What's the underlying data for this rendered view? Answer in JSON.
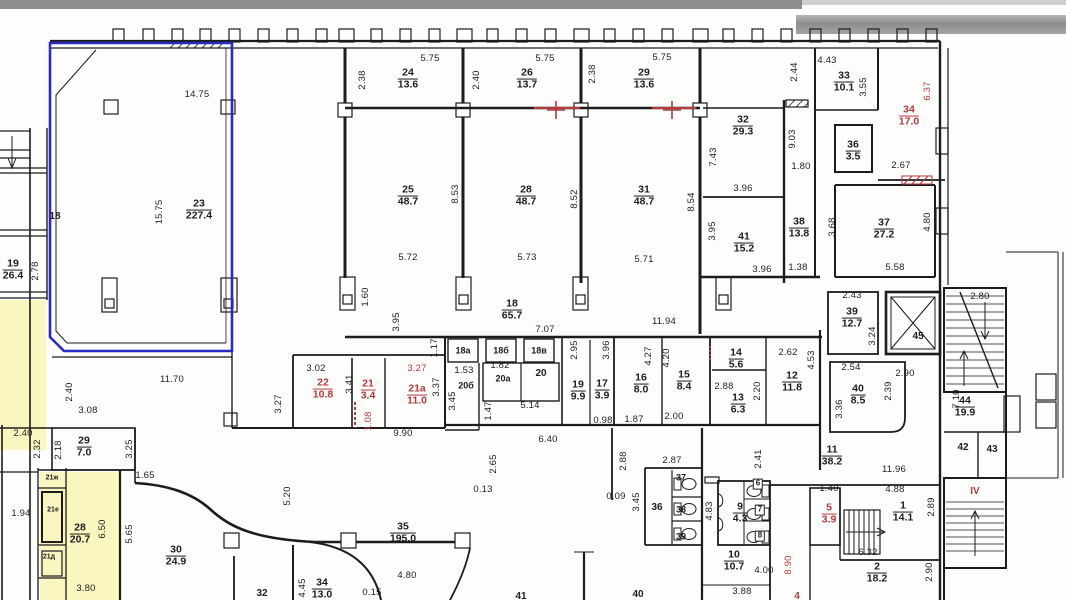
{
  "plan": {
    "type": "architectural floor plan (scanned)",
    "colors": {
      "wall": "#1c1c1c",
      "highlight_outline_blue": "#2a2ac0",
      "accent_red": "#b43b3c",
      "highlight_fill_yellow": "#f8f5b5",
      "scan_edge_gray": "#8d8d8d"
    },
    "rooms": [
      {
        "n": "23",
        "a": "227.4",
        "x": 199,
        "y": 210
      },
      {
        "n": "24",
        "a": "13.6",
        "x": 408,
        "y": 79
      },
      {
        "n": "26",
        "a": "13.7",
        "x": 527,
        "y": 79
      },
      {
        "n": "29",
        "a": "13.6",
        "x": 644,
        "y": 79
      },
      {
        "n": "33",
        "a": "10.1",
        "x": 844,
        "y": 82
      },
      {
        "n": "34",
        "a": "17.0",
        "x": 909,
        "y": 116,
        "c": "red"
      },
      {
        "n": "32",
        "a": "29.3",
        "x": 743,
        "y": 126
      },
      {
        "n": "36",
        "a": "3.5",
        "x": 853,
        "y": 151
      },
      {
        "n": "25",
        "a": "48.7",
        "x": 408,
        "y": 196
      },
      {
        "n": "28",
        "a": "48.7",
        "x": 526,
        "y": 196
      },
      {
        "n": "31",
        "a": "48.7",
        "x": 644,
        "y": 196
      },
      {
        "n": "41",
        "a": "15.2",
        "x": 744,
        "y": 243
      },
      {
        "n": "38",
        "a": "13.8",
        "x": 799,
        "y": 228
      },
      {
        "n": "37",
        "a": "27.2",
        "x": 884,
        "y": 229
      },
      {
        "n": "19",
        "a": "26.4",
        "x": 13,
        "y": 270
      },
      {
        "n": "18",
        "a": "65.7",
        "x": 512,
        "y": 310
      },
      {
        "n": "39",
        "a": "12.7",
        "x": 852,
        "y": 318
      },
      {
        "n": "22",
        "a": "10.8",
        "x": 323,
        "y": 389,
        "c": "red"
      },
      {
        "n": "21",
        "a": "3.4",
        "x": 368,
        "y": 390,
        "c": "red"
      },
      {
        "n": "21а",
        "a": "11.0",
        "x": 417,
        "y": 395,
        "c": "red"
      },
      {
        "n": "19",
        "a": "9.9",
        "x": 578,
        "y": 391
      },
      {
        "n": "17",
        "a": "3.9",
        "x": 602,
        "y": 390
      },
      {
        "n": "16",
        "a": "8.0",
        "x": 641,
        "y": 384
      },
      {
        "n": "15",
        "a": "8.4",
        "x": 684,
        "y": 381
      },
      {
        "n": "14",
        "a": "5.6",
        "x": 736,
        "y": 359
      },
      {
        "n": "13",
        "a": "6.3",
        "x": 738,
        "y": 404
      },
      {
        "n": "12",
        "a": "11.8",
        "x": 792,
        "y": 382
      },
      {
        "n": "40",
        "a": "8.5",
        "x": 858,
        "y": 395
      },
      {
        "n": "44",
        "a": "19.9",
        "x": 965,
        "y": 407
      },
      {
        "n": "29",
        "a": "7.0",
        "x": 84,
        "y": 447
      },
      {
        "n": "28",
        "a": "20.7",
        "x": 80,
        "y": 534
      },
      {
        "n": "30",
        "a": "24.9",
        "x": 176,
        "y": 556
      },
      {
        "n": "11",
        "a": "38.2",
        "x": 832,
        "y": 456
      },
      {
        "n": "35",
        "a": "195.0",
        "x": 403,
        "y": 533
      },
      {
        "n": "9",
        "a": "4.3",
        "x": 740,
        "y": 513
      },
      {
        "n": "10",
        "a": "10.7",
        "x": 734,
        "y": 561
      },
      {
        "n": "5",
        "a": "3.9",
        "x": 829,
        "y": 514,
        "c": "red"
      },
      {
        "n": "1",
        "a": "14.1",
        "x": 903,
        "y": 512
      },
      {
        "n": "2",
        "a": "18.2",
        "x": 877,
        "y": 573
      },
      {
        "n": "34",
        "a": "13.0",
        "x": 322,
        "y": 589
      }
    ],
    "texts": [
      {
        "t": "18",
        "x": 55,
        "y": 217
      },
      {
        "t": "18а",
        "x": 463,
        "y": 351,
        "s": 9
      },
      {
        "t": "18б",
        "x": 501,
        "y": 351,
        "s": 9
      },
      {
        "t": "18в",
        "x": 539,
        "y": 351,
        "s": 9
      },
      {
        "t": "20б",
        "x": 466,
        "y": 386,
        "s": 9
      },
      {
        "t": "20а",
        "x": 503,
        "y": 379,
        "s": 9
      },
      {
        "t": "20",
        "x": 541,
        "y": 374
      },
      {
        "t": "45",
        "x": 918,
        "y": 337
      },
      {
        "t": "36",
        "x": 657,
        "y": 508
      },
      {
        "t": "37",
        "x": 681,
        "y": 478,
        "s": 9
      },
      {
        "t": "38",
        "x": 681,
        "y": 510,
        "s": 9
      },
      {
        "t": "39",
        "x": 681,
        "y": 537,
        "s": 9
      },
      {
        "t": "6",
        "x": 758,
        "y": 484,
        "s": 8,
        "b": 1
      },
      {
        "t": "7",
        "x": 760,
        "y": 510,
        "s": 8,
        "b": 1
      },
      {
        "t": "8",
        "x": 760,
        "y": 536,
        "s": 8,
        "b": 1
      },
      {
        "t": "42",
        "x": 963,
        "y": 448
      },
      {
        "t": "43",
        "x": 992,
        "y": 450
      },
      {
        "t": "32",
        "x": 262,
        "y": 594
      },
      {
        "t": "41",
        "x": 521,
        "y": 597
      },
      {
        "t": "40",
        "x": 638,
        "y": 595
      },
      {
        "t": "4",
        "x": 797,
        "y": 597,
        "c": "red"
      },
      {
        "t": "IV",
        "x": 975,
        "y": 492,
        "c": "red"
      },
      {
        "t": "21ж",
        "x": 52,
        "y": 478,
        "s": 7
      },
      {
        "t": "21е",
        "x": 53,
        "y": 510,
        "s": 7
      },
      {
        "t": "21д",
        "x": 49,
        "y": 557,
        "s": 7
      }
    ],
    "dimensions": [
      {
        "t": "14.75",
        "x": 197,
        "y": 95
      },
      {
        "t": "15.75",
        "x": 160,
        "y": 212,
        "r": 1
      },
      {
        "t": "5.75",
        "x": 430,
        "y": 59
      },
      {
        "t": "5.75",
        "x": 545,
        "y": 59
      },
      {
        "t": "5.75",
        "x": 662,
        "y": 58
      },
      {
        "t": "2.38",
        "x": 363,
        "y": 80,
        "r": 1
      },
      {
        "t": "2.40",
        "x": 477,
        "y": 80,
        "r": 1
      },
      {
        "t": "2.38",
        "x": 593,
        "y": 74,
        "r": 1
      },
      {
        "t": "2.44",
        "x": 795,
        "y": 72,
        "r": 1
      },
      {
        "t": "4.43",
        "x": 827,
        "y": 61
      },
      {
        "t": "3.55",
        "x": 864,
        "y": 87,
        "r": 1
      },
      {
        "t": "6.37",
        "x": 928,
        "y": 91,
        "r": 1,
        "c": "red"
      },
      {
        "t": "9.03",
        "x": 793,
        "y": 139,
        "r": 1
      },
      {
        "t": "1.80",
        "x": 801,
        "y": 167
      },
      {
        "t": "2.67",
        "x": 901,
        "y": 166
      },
      {
        "t": "7.43",
        "x": 714,
        "y": 157,
        "r": 1
      },
      {
        "t": "3.96",
        "x": 743,
        "y": 189
      },
      {
        "t": "8.53",
        "x": 456,
        "y": 194,
        "r": 1
      },
      {
        "t": "8.52",
        "x": 575,
        "y": 199,
        "r": 1
      },
      {
        "t": "8.54",
        "x": 692,
        "y": 202,
        "r": 1
      },
      {
        "t": "3.68",
        "x": 833,
        "y": 227,
        "r": 1
      },
      {
        "t": "4.80",
        "x": 928,
        "y": 222,
        "r": 1
      },
      {
        "t": "3.95",
        "x": 713,
        "y": 231,
        "r": 1
      },
      {
        "t": "5.72",
        "x": 408,
        "y": 258
      },
      {
        "t": "5.73",
        "x": 527,
        "y": 258
      },
      {
        "t": "5.71",
        "x": 644,
        "y": 260
      },
      {
        "t": "3.96",
        "x": 762,
        "y": 270
      },
      {
        "t": "1.38",
        "x": 798,
        "y": 268
      },
      {
        "t": "5.58",
        "x": 895,
        "y": 268
      },
      {
        "t": "2.78",
        "x": 36,
        "y": 271,
        "r": 1
      },
      {
        "t": "2.43",
        "x": 852,
        "y": 296
      },
      {
        "t": "2.80",
        "x": 980,
        "y": 297
      },
      {
        "t": "1.60",
        "x": 366,
        "y": 297,
        "r": 1
      },
      {
        "t": "3.95",
        "x": 397,
        "y": 322,
        "r": 1
      },
      {
        "t": "7.07",
        "x": 545,
        "y": 330
      },
      {
        "t": "11.94",
        "x": 664,
        "y": 322
      },
      {
        "t": "3.24",
        "x": 873,
        "y": 336,
        "r": 1
      },
      {
        "t": "1.17",
        "x": 435,
        "y": 348,
        "r": 1
      },
      {
        "t": "2.95",
        "x": 575,
        "y": 350,
        "r": 1
      },
      {
        "t": "3.96",
        "x": 607,
        "y": 350,
        "r": 1
      },
      {
        "t": "2.62",
        "x": 788,
        "y": 353
      },
      {
        "t": "4.53",
        "x": 812,
        "y": 360,
        "r": 1
      },
      {
        "t": "2.90",
        "x": 905,
        "y": 374
      },
      {
        "t": "3.02",
        "x": 316,
        "y": 369
      },
      {
        "t": "3.27",
        "x": 417,
        "y": 369,
        "c": "red"
      },
      {
        "t": "3.41",
        "x": 350,
        "y": 384,
        "r": 1
      },
      {
        "t": "3.27",
        "x": 279,
        "y": 404,
        "r": 1
      },
      {
        "t": "3.37",
        "x": 437,
        "y": 387,
        "r": 1
      },
      {
        "t": "1.53",
        "x": 464,
        "y": 371
      },
      {
        "t": "1.82",
        "x": 500,
        "y": 366
      },
      {
        "t": "4.27",
        "x": 649,
        "y": 356,
        "r": 1
      },
      {
        "t": "4.20",
        "x": 667,
        "y": 358,
        "r": 1
      },
      {
        "t": "2.88",
        "x": 724,
        "y": 387
      },
      {
        "t": "2.20",
        "x": 758,
        "y": 391,
        "r": 1
      },
      {
        "t": "2.54",
        "x": 851,
        "y": 368
      },
      {
        "t": "2.39",
        "x": 889,
        "y": 391,
        "r": 1
      },
      {
        "t": "3.36",
        "x": 840,
        "y": 409,
        "r": 1
      },
      {
        "t": "11.70",
        "x": 172,
        "y": 380
      },
      {
        "t": "2.40",
        "x": 70,
        "y": 392,
        "r": 1
      },
      {
        "t": "3.08",
        "x": 88,
        "y": 411
      },
      {
        "t": "3.45",
        "x": 453,
        "y": 401,
        "r": 1
      },
      {
        "t": "1.47",
        "x": 489,
        "y": 411,
        "r": 1
      },
      {
        "t": "1.08",
        "x": 369,
        "y": 421,
        "r": 1,
        "c": "red"
      },
      {
        "t": "5.14",
        "x": 530,
        "y": 406
      },
      {
        "t": "9.90",
        "x": 403,
        "y": 434
      },
      {
        "t": "0.98",
        "x": 603,
        "y": 421
      },
      {
        "t": "1.87",
        "x": 634,
        "y": 420
      },
      {
        "t": "2.00",
        "x": 674,
        "y": 417
      },
      {
        "t": "2.40",
        "x": 23,
        "y": 434
      },
      {
        "t": "2.32",
        "x": 38,
        "y": 449,
        "r": 1
      },
      {
        "t": "2.18",
        "x": 59,
        "y": 450,
        "r": 1
      },
      {
        "t": "3.25",
        "x": 130,
        "y": 449,
        "r": 1
      },
      {
        "t": "1.65",
        "x": 145,
        "y": 476
      },
      {
        "t": "1.94",
        "x": 21,
        "y": 514
      },
      {
        "t": "6.50",
        "x": 103,
        "y": 529,
        "r": 1
      },
      {
        "t": "5.65",
        "x": 130,
        "y": 534,
        "r": 1
      },
      {
        "t": "5.20",
        "x": 288,
        "y": 496,
        "r": 1
      },
      {
        "t": "6.40",
        "x": 548,
        "y": 440
      },
      {
        "t": "2.65",
        "x": 494,
        "y": 464,
        "r": 1
      },
      {
        "t": "0.13",
        "x": 483,
        "y": 490
      },
      {
        "t": "2.88",
        "x": 624,
        "y": 461,
        "r": 1
      },
      {
        "t": "0.09",
        "x": 616,
        "y": 497
      },
      {
        "t": "3.45",
        "x": 637,
        "y": 502,
        "r": 1
      },
      {
        "t": "2.87",
        "x": 672,
        "y": 461
      },
      {
        "t": "4.83",
        "x": 710,
        "y": 511,
        "r": 1
      },
      {
        "t": "2.41",
        "x": 759,
        "y": 459,
        "r": 1
      },
      {
        "t": "11.96",
        "x": 894,
        "y": 470
      },
      {
        "t": "4.88",
        "x": 895,
        "y": 490
      },
      {
        "t": "1.40",
        "x": 829,
        "y": 489
      },
      {
        "t": "2.89",
        "x": 932,
        "y": 507,
        "r": 1
      },
      {
        "t": "6.32",
        "x": 868,
        "y": 553
      },
      {
        "t": "2.90",
        "x": 930,
        "y": 572,
        "r": 1
      },
      {
        "t": "7.10",
        "x": 957,
        "y": 399,
        "r": 1
      },
      {
        "t": "4.00",
        "x": 764,
        "y": 571
      },
      {
        "t": "3.88",
        "x": 742,
        "y": 592
      },
      {
        "t": "8.90",
        "x": 789,
        "y": 565,
        "r": 1,
        "c": "red"
      },
      {
        "t": "4.80",
        "x": 407,
        "y": 576
      },
      {
        "t": "0.15",
        "x": 372,
        "y": 593
      },
      {
        "t": "4.45",
        "x": 303,
        "y": 588,
        "r": 1
      },
      {
        "t": "3.80",
        "x": 86,
        "y": 589
      }
    ]
  }
}
